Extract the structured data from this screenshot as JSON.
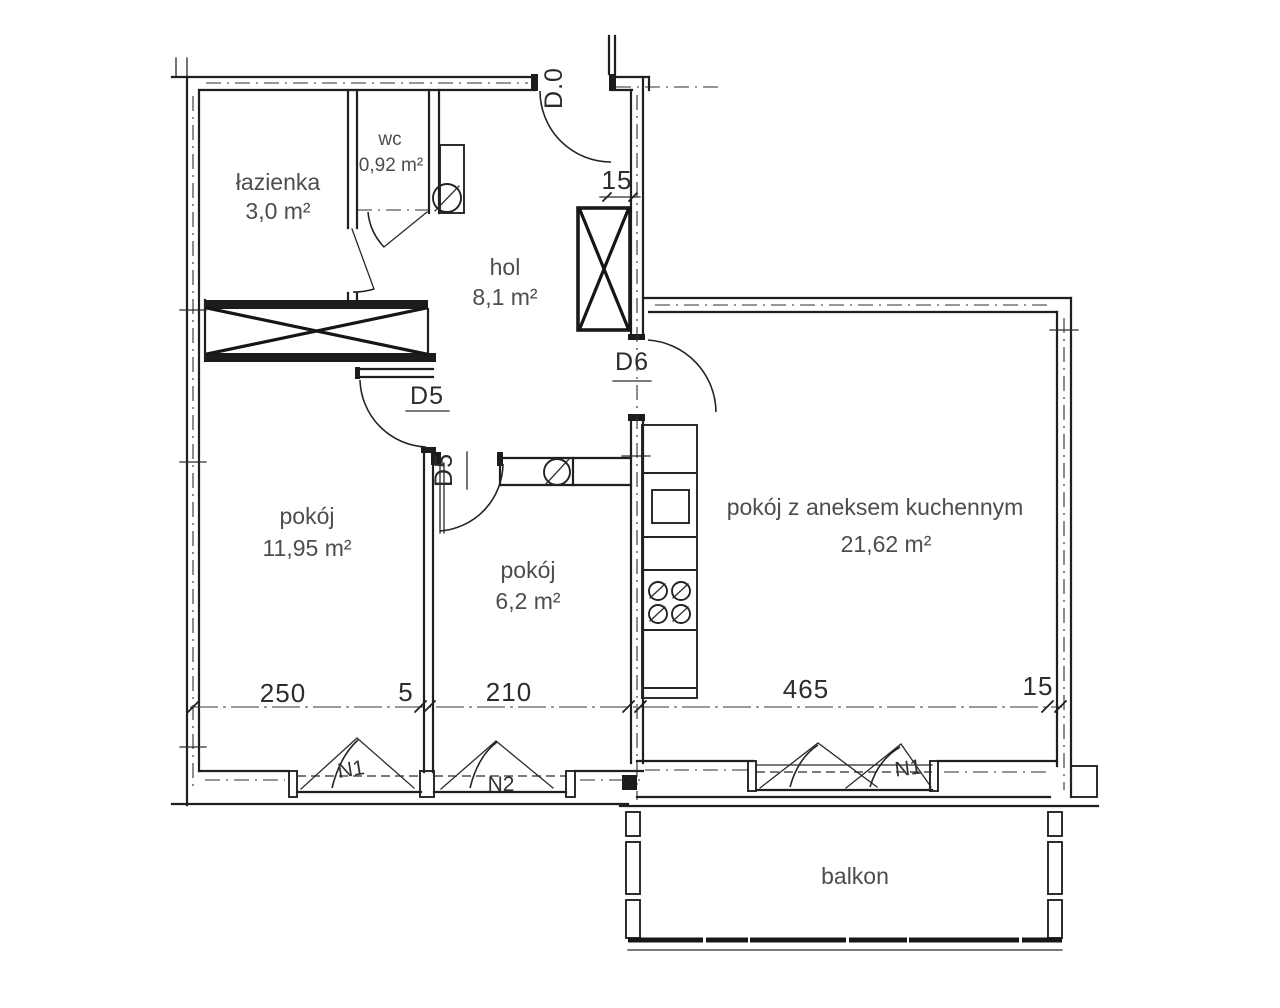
{
  "plan": {
    "rooms": [
      {
        "name": "łazienka",
        "area": "3,0 m²"
      },
      {
        "name": "wc",
        "area": "0,92 m²"
      },
      {
        "name": "hol",
        "area": "8,1 m²"
      },
      {
        "name": "pokój",
        "area": "11,95 m²"
      },
      {
        "name": "pokój",
        "area": "6,2 m²"
      },
      {
        "name": "pokój z aneksem kuchennym",
        "area": "21,62 m²"
      },
      {
        "name": "balkon",
        "area": ""
      }
    ],
    "doors": [
      {
        "label": "D.0"
      },
      {
        "label": "D5"
      },
      {
        "label": "D5"
      },
      {
        "label": "D6"
      }
    ],
    "windows": [
      {
        "label": "N1"
      },
      {
        "label": "N2"
      },
      {
        "label": "N1"
      }
    ],
    "dimensions": {
      "bottom": [
        "250",
        "5",
        "210",
        "465",
        "15"
      ],
      "wall_thickness": "15"
    },
    "colors": {
      "ink": "#1f1f1f",
      "label": "#4d4d4d",
      "code": "#2b2b2b",
      "background": "#ffffff"
    }
  }
}
